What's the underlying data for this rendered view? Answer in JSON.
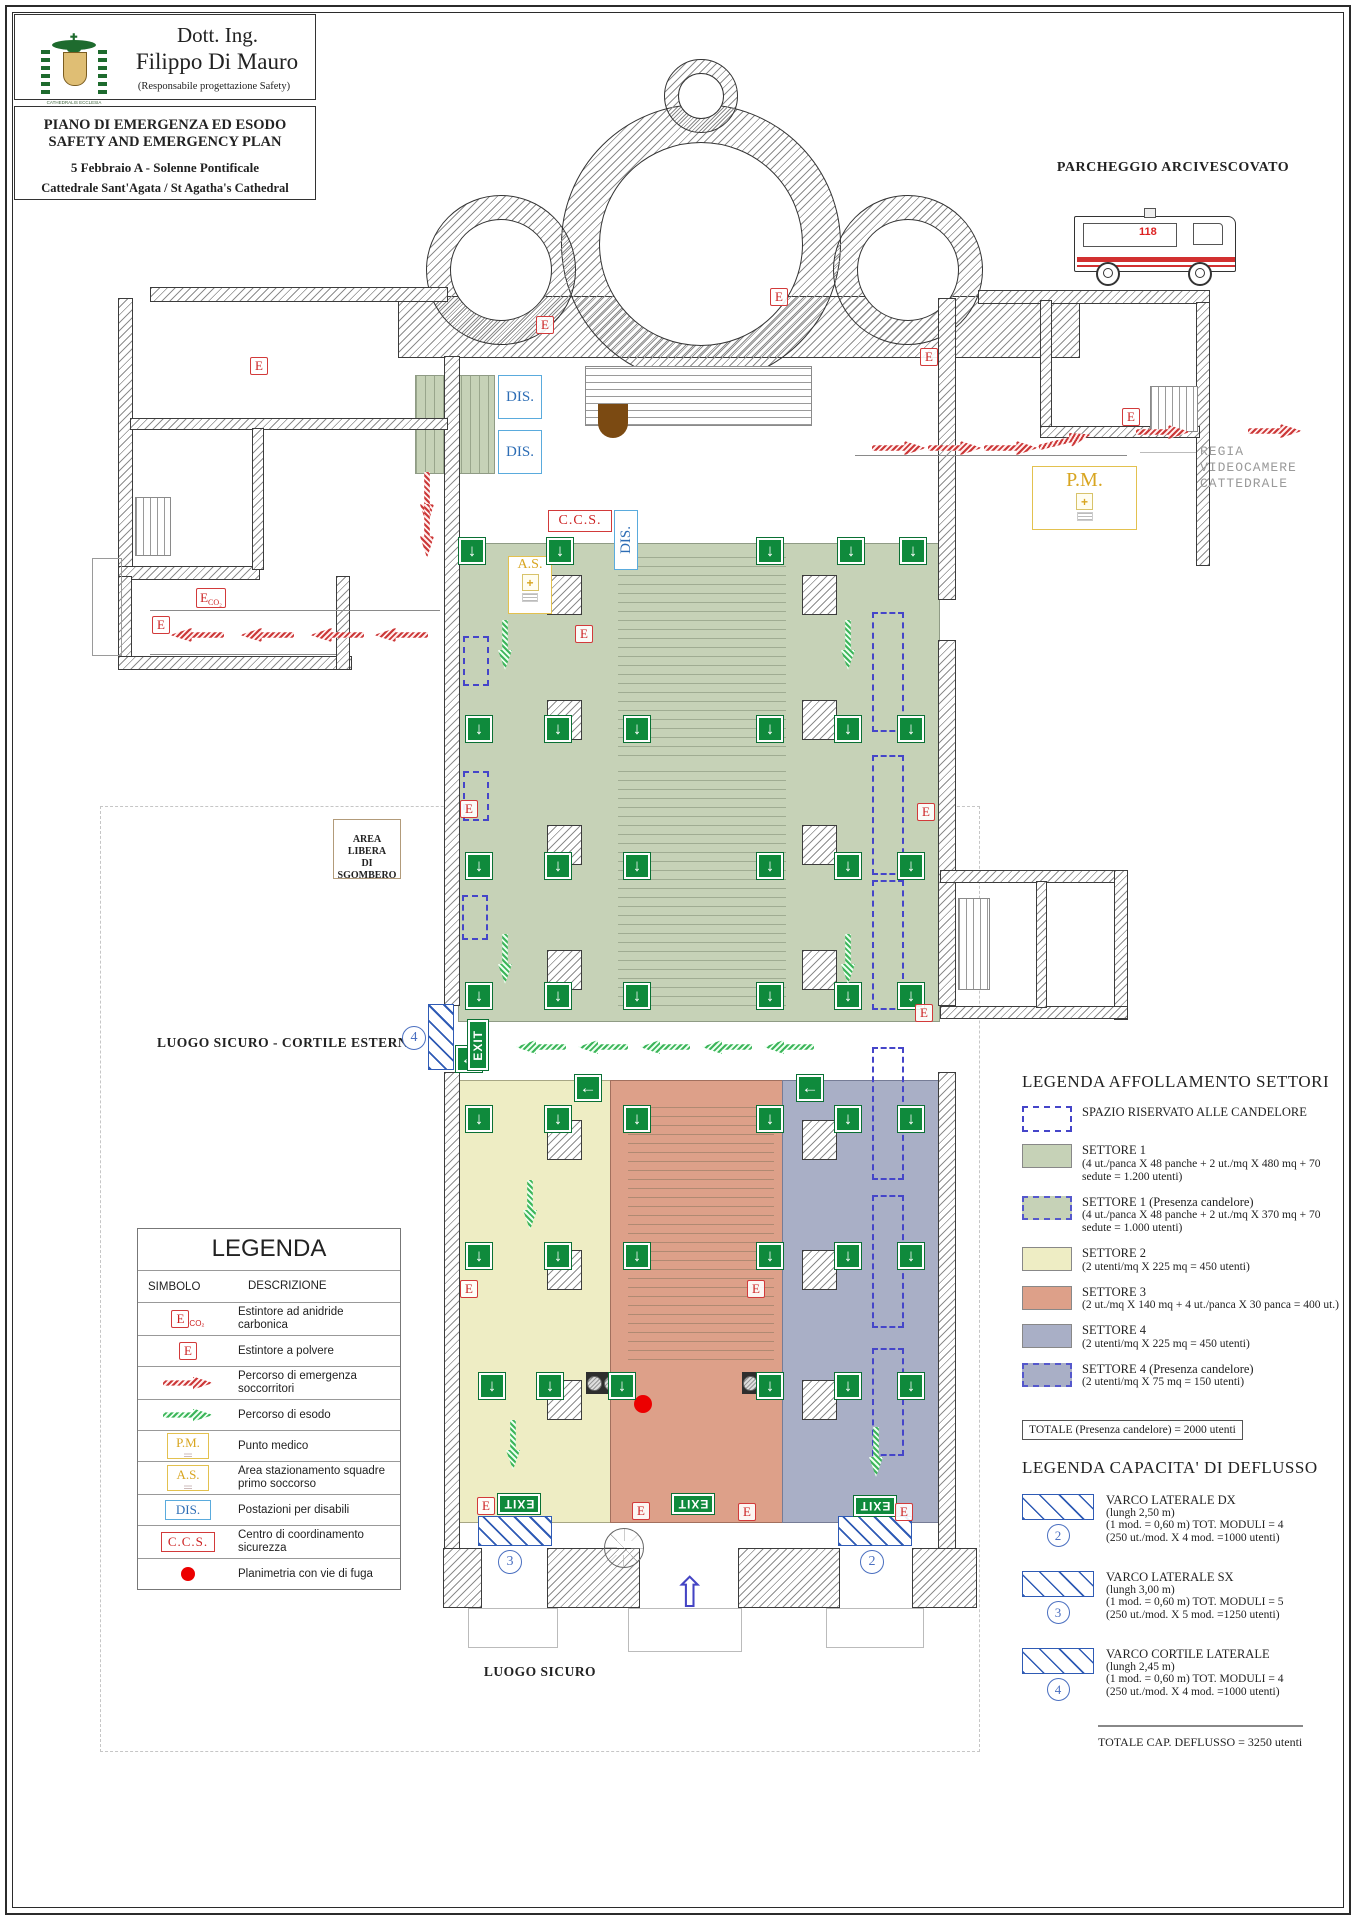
{
  "header": {
    "title_line1": "Dott. Ing.",
    "title_line2": "Filippo Di Mauro",
    "subtitle": "(Responsabile progettazione Safety)",
    "logo_caption": "CATHEDRALIS ECCLESIA CATANENSIS"
  },
  "title_block": {
    "line1": "PIANO DI EMERGENZA ED ESODO",
    "line2": "SAFETY AND EMERGENCY PLAN",
    "line3": "5 Febbraio A - Solenne Pontificale",
    "line4": "Cattedrale Sant'Agata / St Agatha's Cathedral"
  },
  "plan": {
    "parking_label": "PARCHEGGIO ARCIVESCOVATO",
    "ambulance_number": "118",
    "regia_l1": "REGIA",
    "regia_l2": "VIDEOCAMERE",
    "regia_l3": "CATTEDRALE",
    "area_libera_l1": "AREA LIBERA",
    "area_libera_l2": "DI SGOMBERO",
    "luogo_sicuro_cortile": "LUOGO SICURO - CORTILE ESTERNO",
    "luogo_sicuro": "LUOGO SICURO",
    "pm_label": "P.M.",
    "as_label": "A.S.",
    "ccs_label": "C.C.S.",
    "dis_label": "DIS.",
    "plus_glyph": "+",
    "up_arrow_glyph": "⇧",
    "exit_squares": [
      {
        "x": 459,
        "y": 538,
        "g": "↓"
      },
      {
        "x": 547,
        "y": 538,
        "g": "↓"
      },
      {
        "x": 757,
        "y": 538,
        "g": "↓"
      },
      {
        "x": 838,
        "y": 538,
        "g": "↓"
      },
      {
        "x": 900,
        "y": 538,
        "g": "↓"
      },
      {
        "x": 466,
        "y": 716,
        "g": "↓"
      },
      {
        "x": 545,
        "y": 716,
        "g": "↓"
      },
      {
        "x": 624,
        "y": 716,
        "g": "↓"
      },
      {
        "x": 757,
        "y": 716,
        "g": "↓"
      },
      {
        "x": 835,
        "y": 716,
        "g": "↓"
      },
      {
        "x": 898,
        "y": 716,
        "g": "↓"
      },
      {
        "x": 466,
        "y": 853,
        "g": "↓"
      },
      {
        "x": 545,
        "y": 853,
        "g": "↓"
      },
      {
        "x": 624,
        "y": 853,
        "g": "↓"
      },
      {
        "x": 757,
        "y": 853,
        "g": "↓"
      },
      {
        "x": 835,
        "y": 853,
        "g": "↓"
      },
      {
        "x": 898,
        "y": 853,
        "g": "↓"
      },
      {
        "x": 466,
        "y": 983,
        "g": "↓"
      },
      {
        "x": 545,
        "y": 983,
        "g": "↓"
      },
      {
        "x": 624,
        "y": 983,
        "g": "↓"
      },
      {
        "x": 757,
        "y": 983,
        "g": "↓"
      },
      {
        "x": 835,
        "y": 983,
        "g": "↓"
      },
      {
        "x": 898,
        "y": 983,
        "g": "↓"
      },
      {
        "x": 466,
        "y": 1106,
        "g": "↓"
      },
      {
        "x": 545,
        "y": 1106,
        "g": "↓"
      },
      {
        "x": 624,
        "y": 1106,
        "g": "↓"
      },
      {
        "x": 757,
        "y": 1106,
        "g": "↓"
      },
      {
        "x": 835,
        "y": 1106,
        "g": "↓"
      },
      {
        "x": 898,
        "y": 1106,
        "g": "↓"
      },
      {
        "x": 466,
        "y": 1243,
        "g": "↓"
      },
      {
        "x": 545,
        "y": 1243,
        "g": "↓"
      },
      {
        "x": 624,
        "y": 1243,
        "g": "↓"
      },
      {
        "x": 757,
        "y": 1243,
        "g": "↓"
      },
      {
        "x": 835,
        "y": 1243,
        "g": "↓"
      },
      {
        "x": 898,
        "y": 1243,
        "g": "↓"
      },
      {
        "x": 479,
        "y": 1373,
        "g": "↓"
      },
      {
        "x": 537,
        "y": 1373,
        "g": "↓"
      },
      {
        "x": 609,
        "y": 1373,
        "g": "↓"
      },
      {
        "x": 757,
        "y": 1373,
        "g": "↓"
      },
      {
        "x": 835,
        "y": 1373,
        "g": "↓"
      },
      {
        "x": 898,
        "y": 1373,
        "g": "↓"
      },
      {
        "x": 575,
        "y": 1075,
        "g": "←"
      },
      {
        "x": 797,
        "y": 1075,
        "g": "←"
      },
      {
        "x": 456,
        "y": 1046,
        "g": "←"
      }
    ],
    "exit_signs": [
      {
        "x": 498,
        "y": 1494,
        "w": 42,
        "h": 20,
        "r": 180,
        "g": "EXIT"
      },
      {
        "x": 672,
        "y": 1494,
        "w": 42,
        "h": 20,
        "r": 180,
        "g": "EXIT"
      },
      {
        "x": 854,
        "y": 1496,
        "w": 42,
        "h": 20,
        "r": 180,
        "g": "EXIT"
      },
      {
        "x": 468,
        "y": 1020,
        "w": 20,
        "h": 50,
        "cls": "vert",
        "g": "EXIT"
      }
    ],
    "extinguishers": [
      {
        "x": 250,
        "y": 357
      },
      {
        "x": 536,
        "y": 316
      },
      {
        "x": 770,
        "y": 288
      },
      {
        "x": 920,
        "y": 348
      },
      {
        "x": 1122,
        "y": 408
      },
      {
        "x": 152,
        "y": 616
      },
      {
        "x": 575,
        "y": 625
      },
      {
        "x": 460,
        "y": 800
      },
      {
        "x": 917,
        "y": 803
      },
      {
        "x": 915,
        "y": 1004
      },
      {
        "x": 460,
        "y": 1280
      },
      {
        "x": 747,
        "y": 1280
      },
      {
        "x": 477,
        "y": 1497
      },
      {
        "x": 632,
        "y": 1502
      },
      {
        "x": 738,
        "y": 1503
      },
      {
        "x": 895,
        "y": 1503
      }
    ],
    "extinguishers_co2": [
      {
        "x": 196,
        "y": 588,
        "g": "E",
        "sub": "CO₂"
      }
    ],
    "red_arrows": [
      {
        "x": 872,
        "y": 441
      },
      {
        "x": 928,
        "y": 441
      },
      {
        "x": 984,
        "y": 441
      },
      {
        "x": 1038,
        "y": 434,
        "r": -14
      },
      {
        "x": 1136,
        "y": 425
      },
      {
        "x": 1248,
        "y": 424
      },
      {
        "x": 170,
        "y": 628,
        "r": 180
      },
      {
        "x": 240,
        "y": 628,
        "r": 180
      },
      {
        "x": 310,
        "y": 628,
        "r": 180
      },
      {
        "x": 374,
        "y": 628,
        "r": 180
      },
      {
        "x": 400,
        "y": 492,
        "r": 90
      },
      {
        "x": 400,
        "y": 524,
        "r": 90
      }
    ],
    "green_arrows": [
      {
        "x": 480,
        "y": 638,
        "r": 90
      },
      {
        "x": 823,
        "y": 638,
        "r": 90
      },
      {
        "x": 480,
        "y": 952,
        "r": 90
      },
      {
        "x": 823,
        "y": 952,
        "r": 90
      },
      {
        "x": 516,
        "y": 1040,
        "r": 180
      },
      {
        "x": 578,
        "y": 1040,
        "r": 180
      },
      {
        "x": 640,
        "y": 1040,
        "r": 180
      },
      {
        "x": 702,
        "y": 1040,
        "r": 180
      },
      {
        "x": 764,
        "y": 1040,
        "r": 180
      },
      {
        "x": 505,
        "y": 1198,
        "r": 90
      },
      {
        "x": 488,
        "y": 1438,
        "r": 90
      },
      {
        "x": 851,
        "y": 1445,
        "r": 90
      }
    ],
    "candelore": [
      {
        "x": 463,
        "y": 636,
        "w": 26,
        "h": 50
      },
      {
        "x": 463,
        "y": 771,
        "w": 26,
        "h": 50
      },
      {
        "x": 462,
        "y": 895,
        "w": 26,
        "h": 45
      },
      {
        "x": 872,
        "y": 612,
        "w": 32,
        "h": 120
      },
      {
        "x": 872,
        "y": 755,
        "w": 32,
        "h": 120
      },
      {
        "x": 872,
        "y": 880,
        "w": 32,
        "h": 130
      },
      {
        "x": 872,
        "y": 1047,
        "w": 32,
        "h": 133
      },
      {
        "x": 872,
        "y": 1195,
        "w": 32,
        "h": 133
      },
      {
        "x": 872,
        "y": 1348,
        "w": 32,
        "h": 108
      }
    ],
    "varchi": [
      {
        "x": 428,
        "y": 1004,
        "w": 26,
        "h": 66
      },
      {
        "x": 478,
        "y": 1516,
        "w": 74,
        "h": 30
      },
      {
        "x": 838,
        "y": 1516,
        "w": 74,
        "h": 30
      }
    ],
    "gate_numbers": [
      {
        "x": 402,
        "y": 1026,
        "g": "4"
      },
      {
        "x": 498,
        "y": 1550,
        "g": "3"
      },
      {
        "x": 860,
        "y": 1550,
        "g": "2"
      }
    ],
    "dis_boxes": [
      {
        "x": 498,
        "y": 375,
        "w": 44,
        "h": 44
      },
      {
        "x": 498,
        "y": 430,
        "w": 44,
        "h": 44
      }
    ]
  },
  "legend": {
    "title": "LEGENDA",
    "col_symbol": "SIMBOLO",
    "col_desc": "DESCRIZIONE",
    "rows": [
      {
        "sym": "sym-eco2",
        "symtext": "E",
        "sub": "CO₂",
        "desc": "Estintore ad anidride carbonica"
      },
      {
        "sym": "sym-e",
        "symtext": "E",
        "desc": "Estintore a polvere"
      },
      {
        "sym": "sym-arrow-red",
        "desc": "Percorso di emergenza soccorritori"
      },
      {
        "sym": "sym-arrow-green",
        "desc": "Percorso di esodo"
      },
      {
        "sym": "sym-pm",
        "symtext": "P.M.",
        "desc": "Punto medico"
      },
      {
        "sym": "sym-as",
        "symtext": "A.S.",
        "desc": "Area stazionamento squadre primo soccorso"
      },
      {
        "sym": "sym-dis",
        "symtext": "DIS.",
        "desc": "Postazioni per disabili"
      },
      {
        "sym": "sym-ccs",
        "symtext": "C.C.S.",
        "desc": "Centro di coordinamento sicurezza"
      },
      {
        "sym": "sym-dot",
        "desc": "Planimetria con vie di fuga"
      }
    ]
  },
  "sector_legend": {
    "title": "LEGENDA AFFOLLAMENTO SETTORI",
    "entries": [
      {
        "sw": "sw-dash",
        "label": "SPAZIO RISERVATO ALLE CANDELORE",
        "detail": ""
      },
      {
        "sw": "sw-green",
        "label": "SETTORE 1",
        "detail": "(4 ut./panca X 48 panche + 2 ut./mq X 480 mq + 70 sedute = 1.200 utenti)"
      },
      {
        "sw": "sw-green sw-dashed",
        "label": "SETTORE 1 (Presenza candelore)",
        "detail": "(4 ut./panca X 48 panche + 2 ut./mq X 370 mq + 70 sedute = 1.000 utenti)"
      },
      {
        "sw": "sw-yellow",
        "label": "SETTORE 2",
        "detail": "(2 utenti/mq X 225 mq = 450 utenti)"
      },
      {
        "sw": "sw-salmon",
        "label": "SETTORE 3",
        "detail": "(2 ut./mq X 140 mq + 4 ut./panca X 30 panca = 400 ut.)"
      },
      {
        "sw": "sw-blue",
        "label": "SETTORE 4",
        "detail": "(2 utenti/mq X 225 mq = 450 utenti)"
      },
      {
        "sw": "sw-blue sw-dashed",
        "label": "SETTORE 4 (Presenza candelore)",
        "detail": "(2 utenti/mq X 75 mq = 150 utenti)"
      }
    ]
  },
  "totale_candelore": "TOTALE (Presenza candelore) = 2000 utenti",
  "deflusso_legend": {
    "title": "LEGENDA CAPACITA' DI DEFLUSSO",
    "entries": [
      {
        "num": "2",
        "title": "VARCO LATERALE DX",
        "l1": "(lungh 2,50 m)",
        "l2": "(1 mod. = 0,60 m)   TOT. MODULI = 4",
        "l3": "(250 ut./mod. X 4 mod. =1000 utenti)"
      },
      {
        "num": "3",
        "title": "VARCO LATERALE SX",
        "l1": "(lungh 3,00 m)",
        "l2": "(1 mod. = 0,60 m)   TOT. MODULI = 5",
        "l3": "(250 ut./mod. X 5 mod. =1250 utenti)"
      },
      {
        "num": "4",
        "title": "VARCO CORTILE LATERALE",
        "l1": "(lungh 2,45 m)",
        "l2": "(1 mod. = 0,60 m)   TOT. MODULI = 4",
        "l3": "(250 ut./mod. X 4 mod. =1000 utenti)"
      }
    ],
    "totale": "TOTALE CAP. DEFLUSSO = 3250 utenti"
  }
}
